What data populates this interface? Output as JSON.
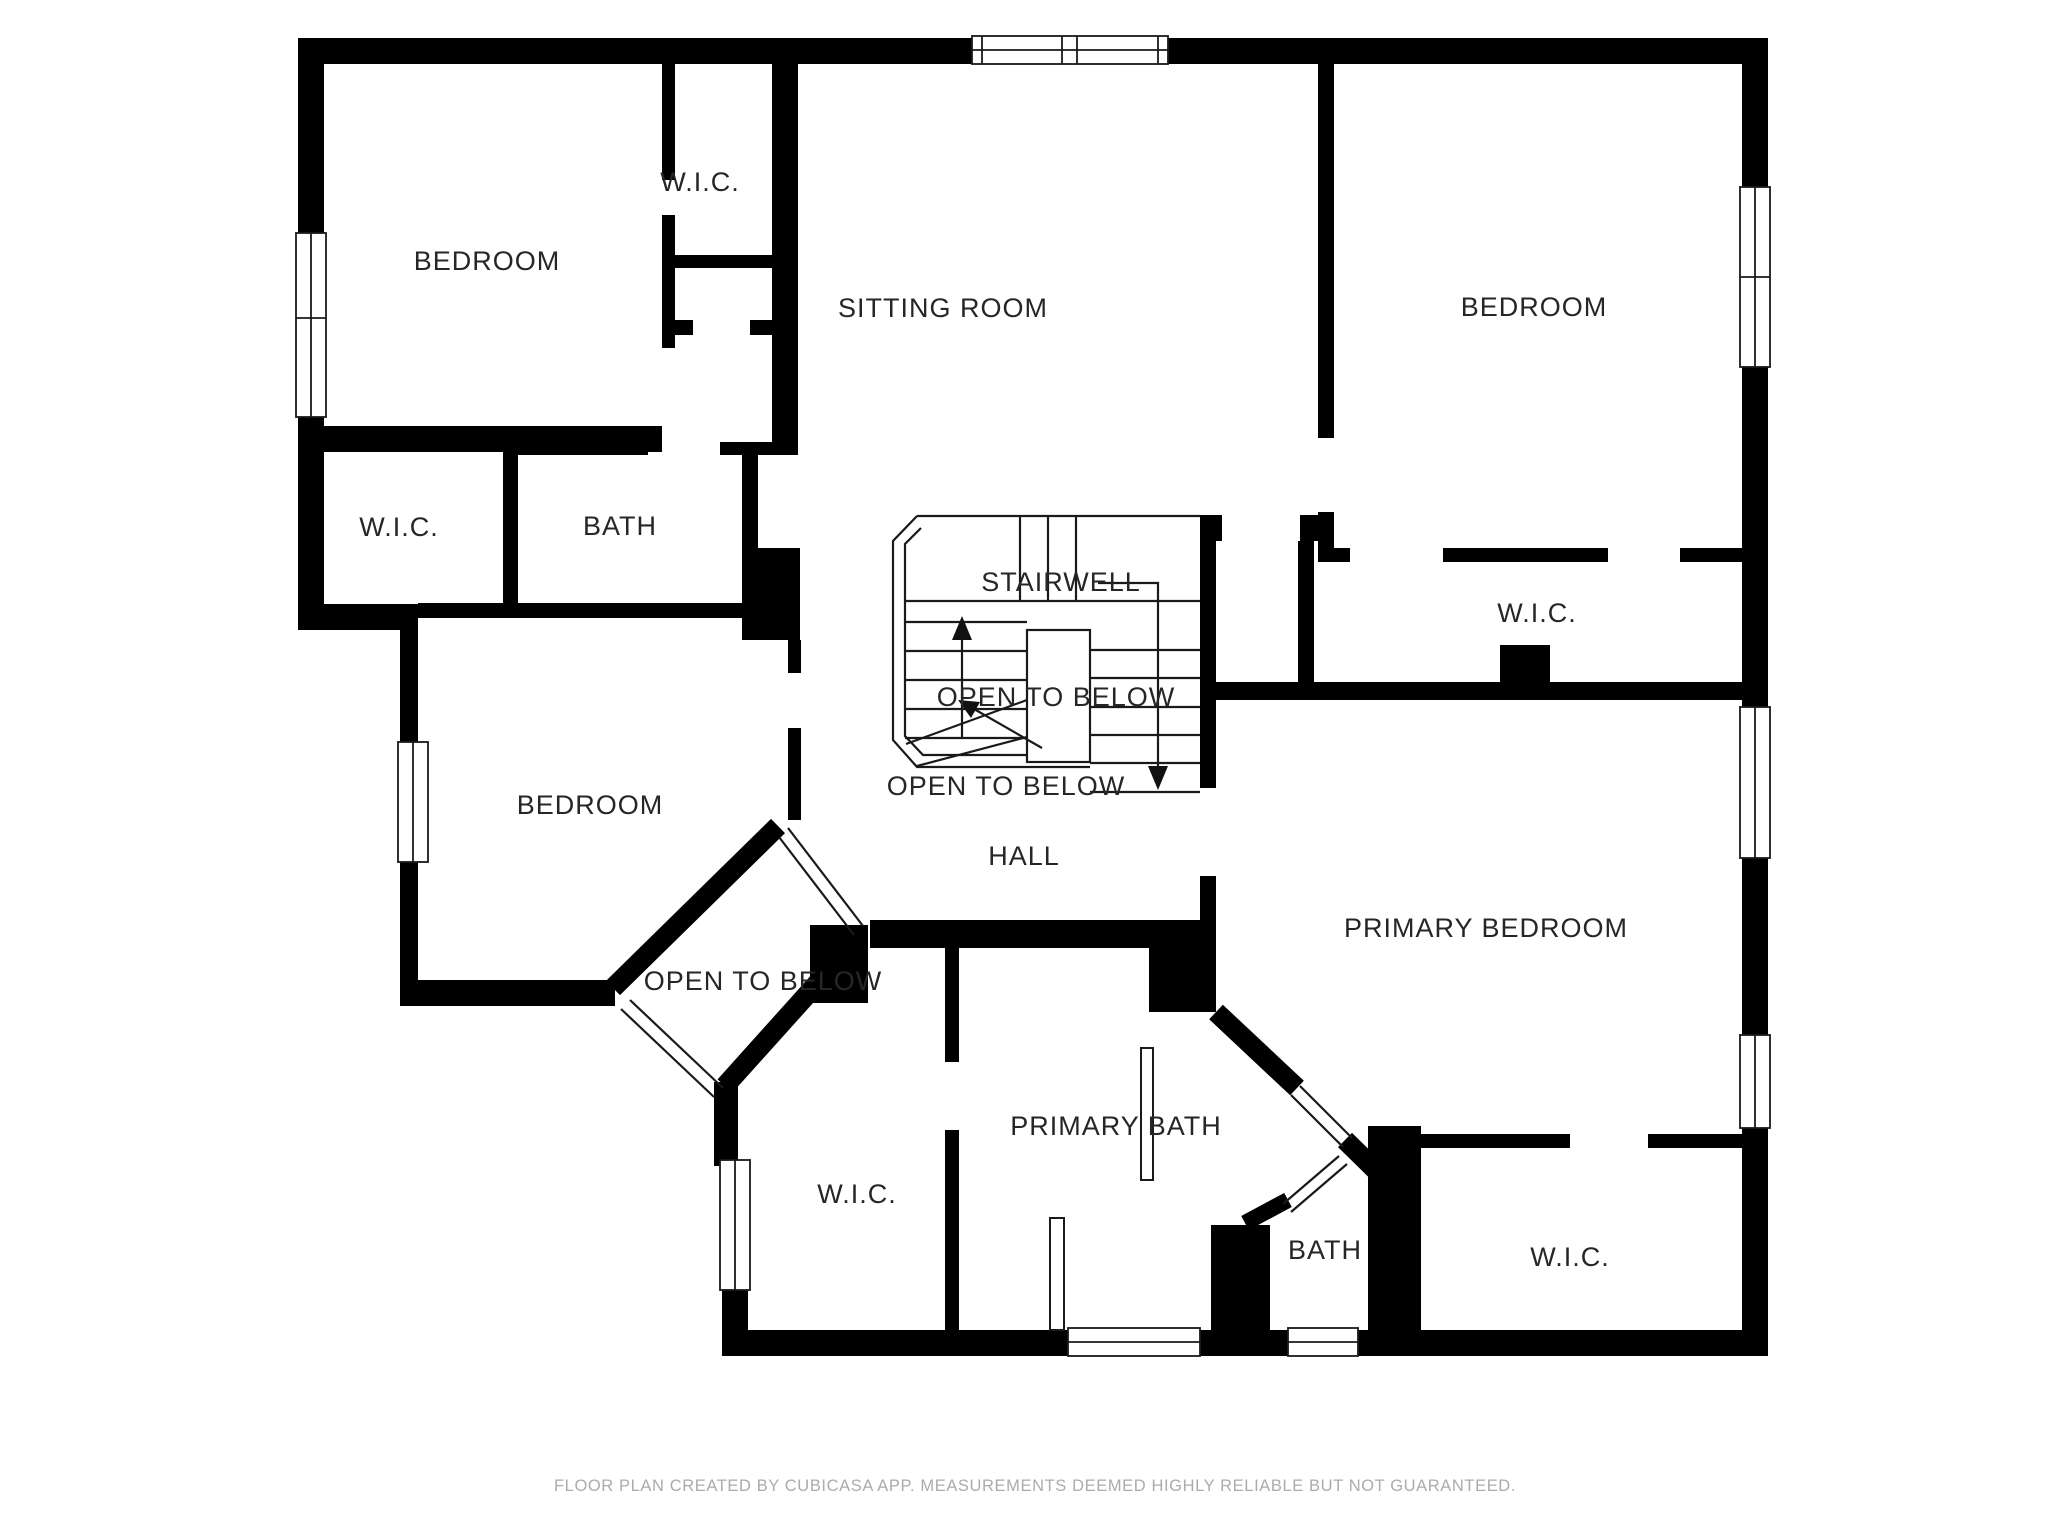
{
  "floor_plan": {
    "rooms": [
      {
        "id": "bedroom-top-left",
        "label": "BEDROOM"
      },
      {
        "id": "wic-top",
        "label": "W.I.C."
      },
      {
        "id": "sitting-room",
        "label": "SITTING ROOM"
      },
      {
        "id": "bedroom-top-right",
        "label": "BEDROOM"
      },
      {
        "id": "wic-mid-left",
        "label": "W.I.C."
      },
      {
        "id": "bath-mid-left",
        "label": "BATH"
      },
      {
        "id": "stairwell",
        "label": "STAIRWELL"
      },
      {
        "id": "open-to-below-stairwell",
        "label": "OPEN TO BELOW"
      },
      {
        "id": "open-to-below-hall",
        "label": "OPEN TO BELOW"
      },
      {
        "id": "bedroom-mid-left",
        "label": "BEDROOM"
      },
      {
        "id": "wic-right",
        "label": "W.I.C."
      },
      {
        "id": "open-to-below-diamond",
        "label": "OPEN TO BELOW"
      },
      {
        "id": "hall",
        "label": "HALL"
      },
      {
        "id": "primary-bedroom",
        "label": "PRIMARY BEDROOM"
      },
      {
        "id": "wic-bottom-left",
        "label": "W.I.C."
      },
      {
        "id": "primary-bath",
        "label": "PRIMARY BATH"
      },
      {
        "id": "bath-bottom-right",
        "label": "BATH"
      },
      {
        "id": "wic-bottom-right",
        "label": "W.I.C."
      }
    ],
    "footer": "FLOOR PLAN CREATED BY CUBICASA APP. MEASUREMENTS DEEMED HIGHLY RELIABLE BUT NOT GUARANTEED.",
    "colors": {
      "wall": "#000000",
      "label": "#262626",
      "footer_text": "#ababab",
      "background": "#ffffff"
    }
  }
}
